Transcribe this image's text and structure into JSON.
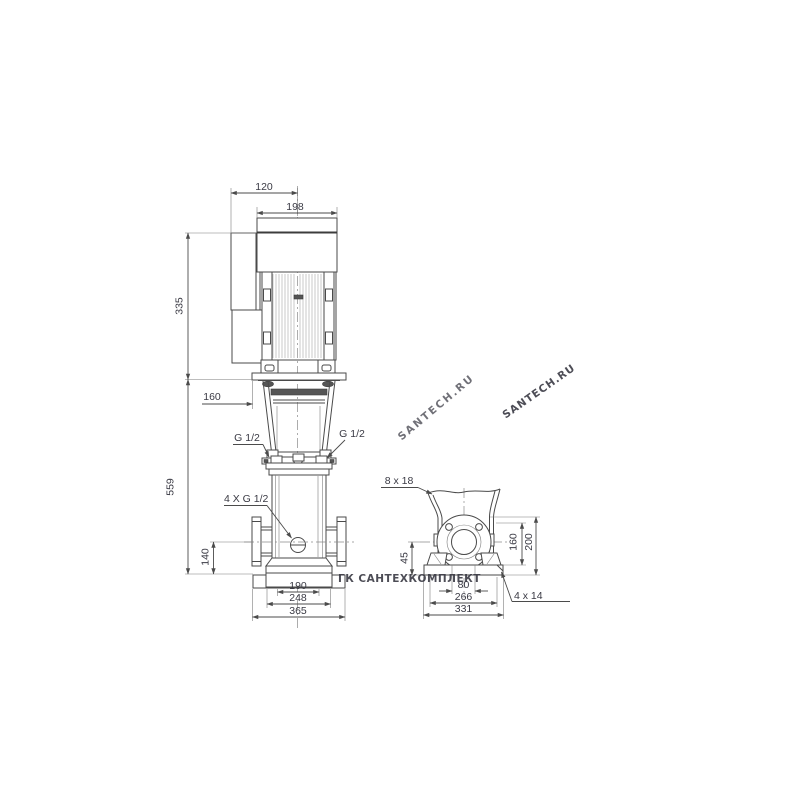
{
  "watermarks": {
    "main": "SANTECH.RU",
    "secondary": "SANTECH.RU",
    "horizontal": "ГК САНТЕХКОМПЛЕКТ"
  },
  "front_view": {
    "d120": "120",
    "d198": "198",
    "d335": "335",
    "d559": "559",
    "d160": "160",
    "d140": "140",
    "g12_left": "G 1/2",
    "g12_right": "G 1/2",
    "g12_4x": "4 X G 1/2",
    "d190": "190",
    "d248": "248",
    "d365": "365"
  },
  "side_view": {
    "holes_top": "8 x 18",
    "d45": "45",
    "d160": "160",
    "d200": "200",
    "d80": "80",
    "d266": "266",
    "d331": "331",
    "holes_base": "4 x 14"
  }
}
